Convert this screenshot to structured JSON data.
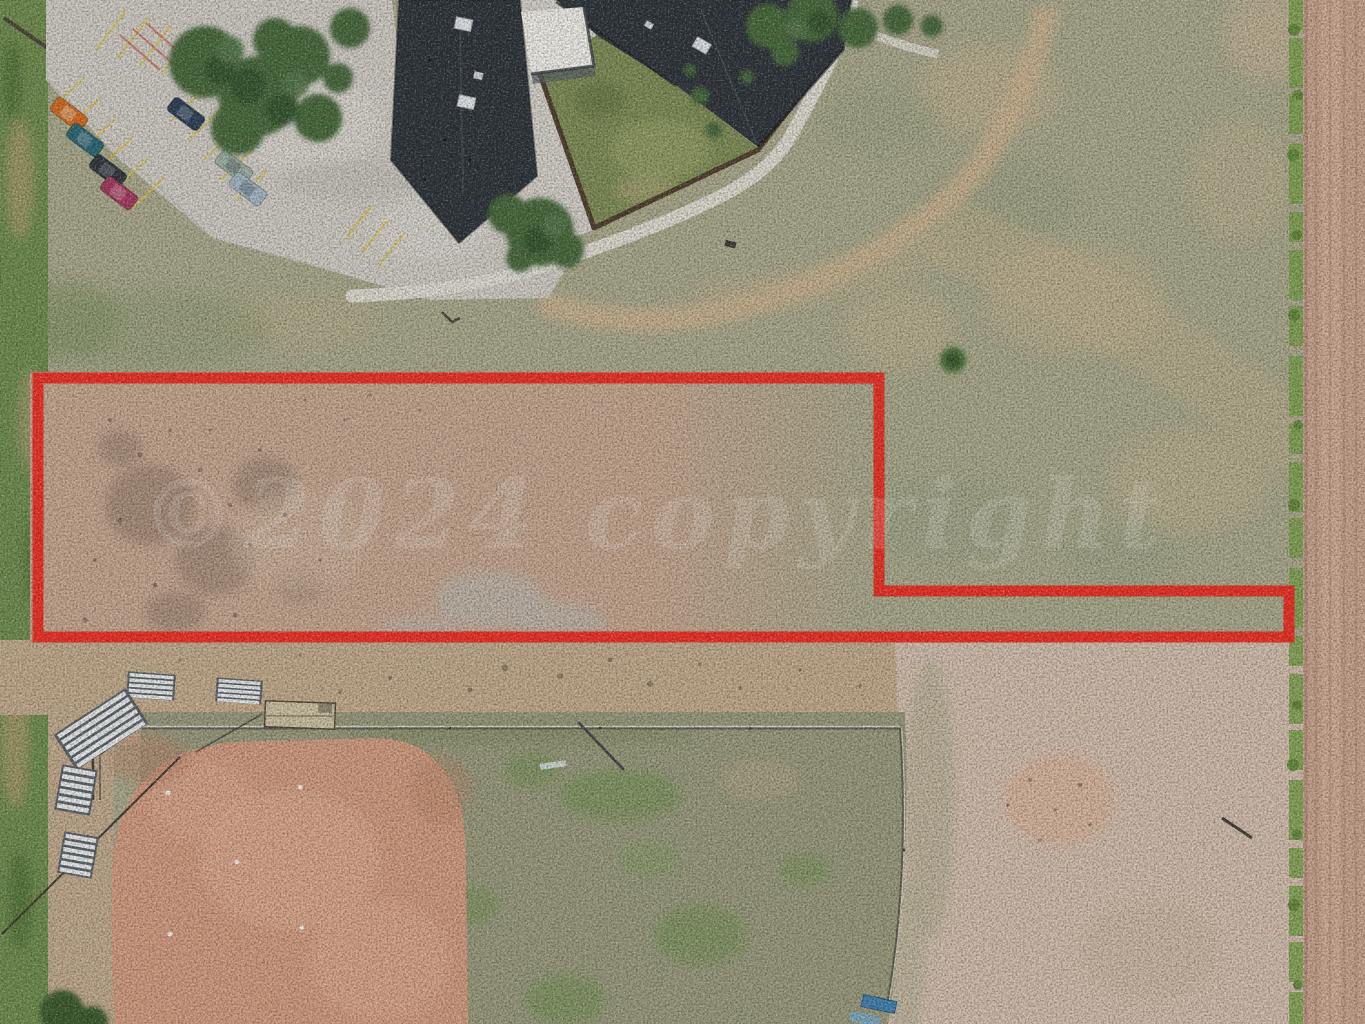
{
  "meta": {
    "canvas": {
      "width": 1365,
      "height": 1024
    }
  },
  "watermark": {
    "text": "©2024 copyright",
    "opacity": 0.14
  },
  "property_outline": {
    "color": "#ee2a20",
    "stroke_width": 11,
    "path": "M 38,378 L 879,378 L 879,591 L 1289,591 L 1289,637 L 38,637 Z"
  },
  "colors": {
    "field_sage": "#a8a78a",
    "parcel_dirt": "#c4a58e",
    "dirt_strip": "#c0a98a",
    "pale_dirt": "#d0bcaa",
    "grass_green": "#6e8b4d",
    "outfield_green": "#97987a",
    "infield_clay": "#d09a7e",
    "concrete": "#cecac2",
    "sidewalk": "#dedbd2",
    "roof_dark": "#2e343a",
    "canopy_white": "#edebe5",
    "yard_green": "#7d8b54",
    "fence_brown": "#4a3827",
    "tree_green": "#47683a",
    "road_pink": "#c7a28c",
    "weed_green": "#7da04e",
    "trail_tan": "#c9b08d",
    "stall_yellow": "#d6c057",
    "bleacher_steel": "#e6e9e9",
    "bleacher_frame": "#5b6167"
  },
  "vehicles": [
    {
      "name": "car-orange",
      "color": "#cf6a1f"
    },
    {
      "name": "car-teal",
      "color": "#2c6673"
    },
    {
      "name": "car-black",
      "color": "#30363e"
    },
    {
      "name": "car-magenta",
      "color": "#a33a5e"
    },
    {
      "name": "car-navy",
      "color": "#2d3f57"
    },
    {
      "name": "car-silver-green",
      "color": "#9cb0a4"
    },
    {
      "name": "car-silver-blue",
      "color": "#a2b6c2"
    }
  ]
}
